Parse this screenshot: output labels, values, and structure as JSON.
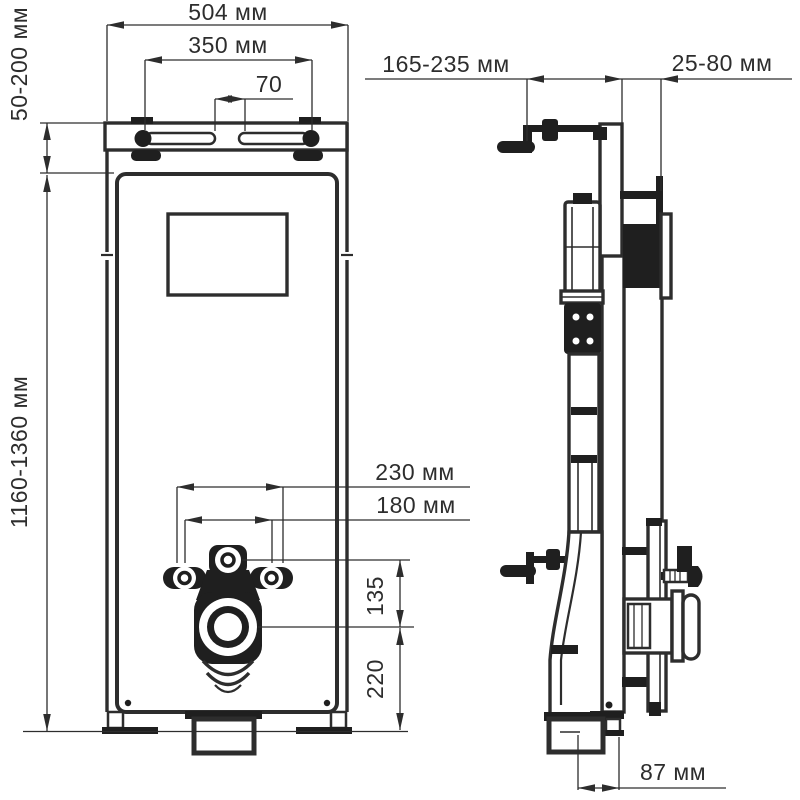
{
  "figure": {
    "kind": "installation technical drawing, front and side view",
    "units": "мм",
    "colors": {
      "line": "#2d2d2d",
      "solid": "#1f1f1f",
      "background": "#ffffff"
    }
  },
  "front_view": {
    "dimensions": {
      "total_width": {
        "label": "504 мм"
      },
      "hanger_bolt_spacing": {
        "label": "350 мм"
      },
      "slot_gap": {
        "label": "70"
      },
      "top_bracket_range": {
        "label": "50-200 мм"
      },
      "frame_height_range": {
        "label": "1160-1360 мм"
      },
      "fixing_outer": {
        "label": "230 мм"
      },
      "fixing_inner": {
        "label": "180 мм"
      },
      "inlet_to_drain": {
        "label": "135"
      },
      "drain_height": {
        "label": "220"
      }
    }
  },
  "side_view": {
    "dimensions": {
      "depth_range": {
        "label": "165-235 мм"
      },
      "wall_clearance": {
        "label": "25-80 мм"
      },
      "drain_offset": {
        "label": "87 мм"
      }
    }
  }
}
